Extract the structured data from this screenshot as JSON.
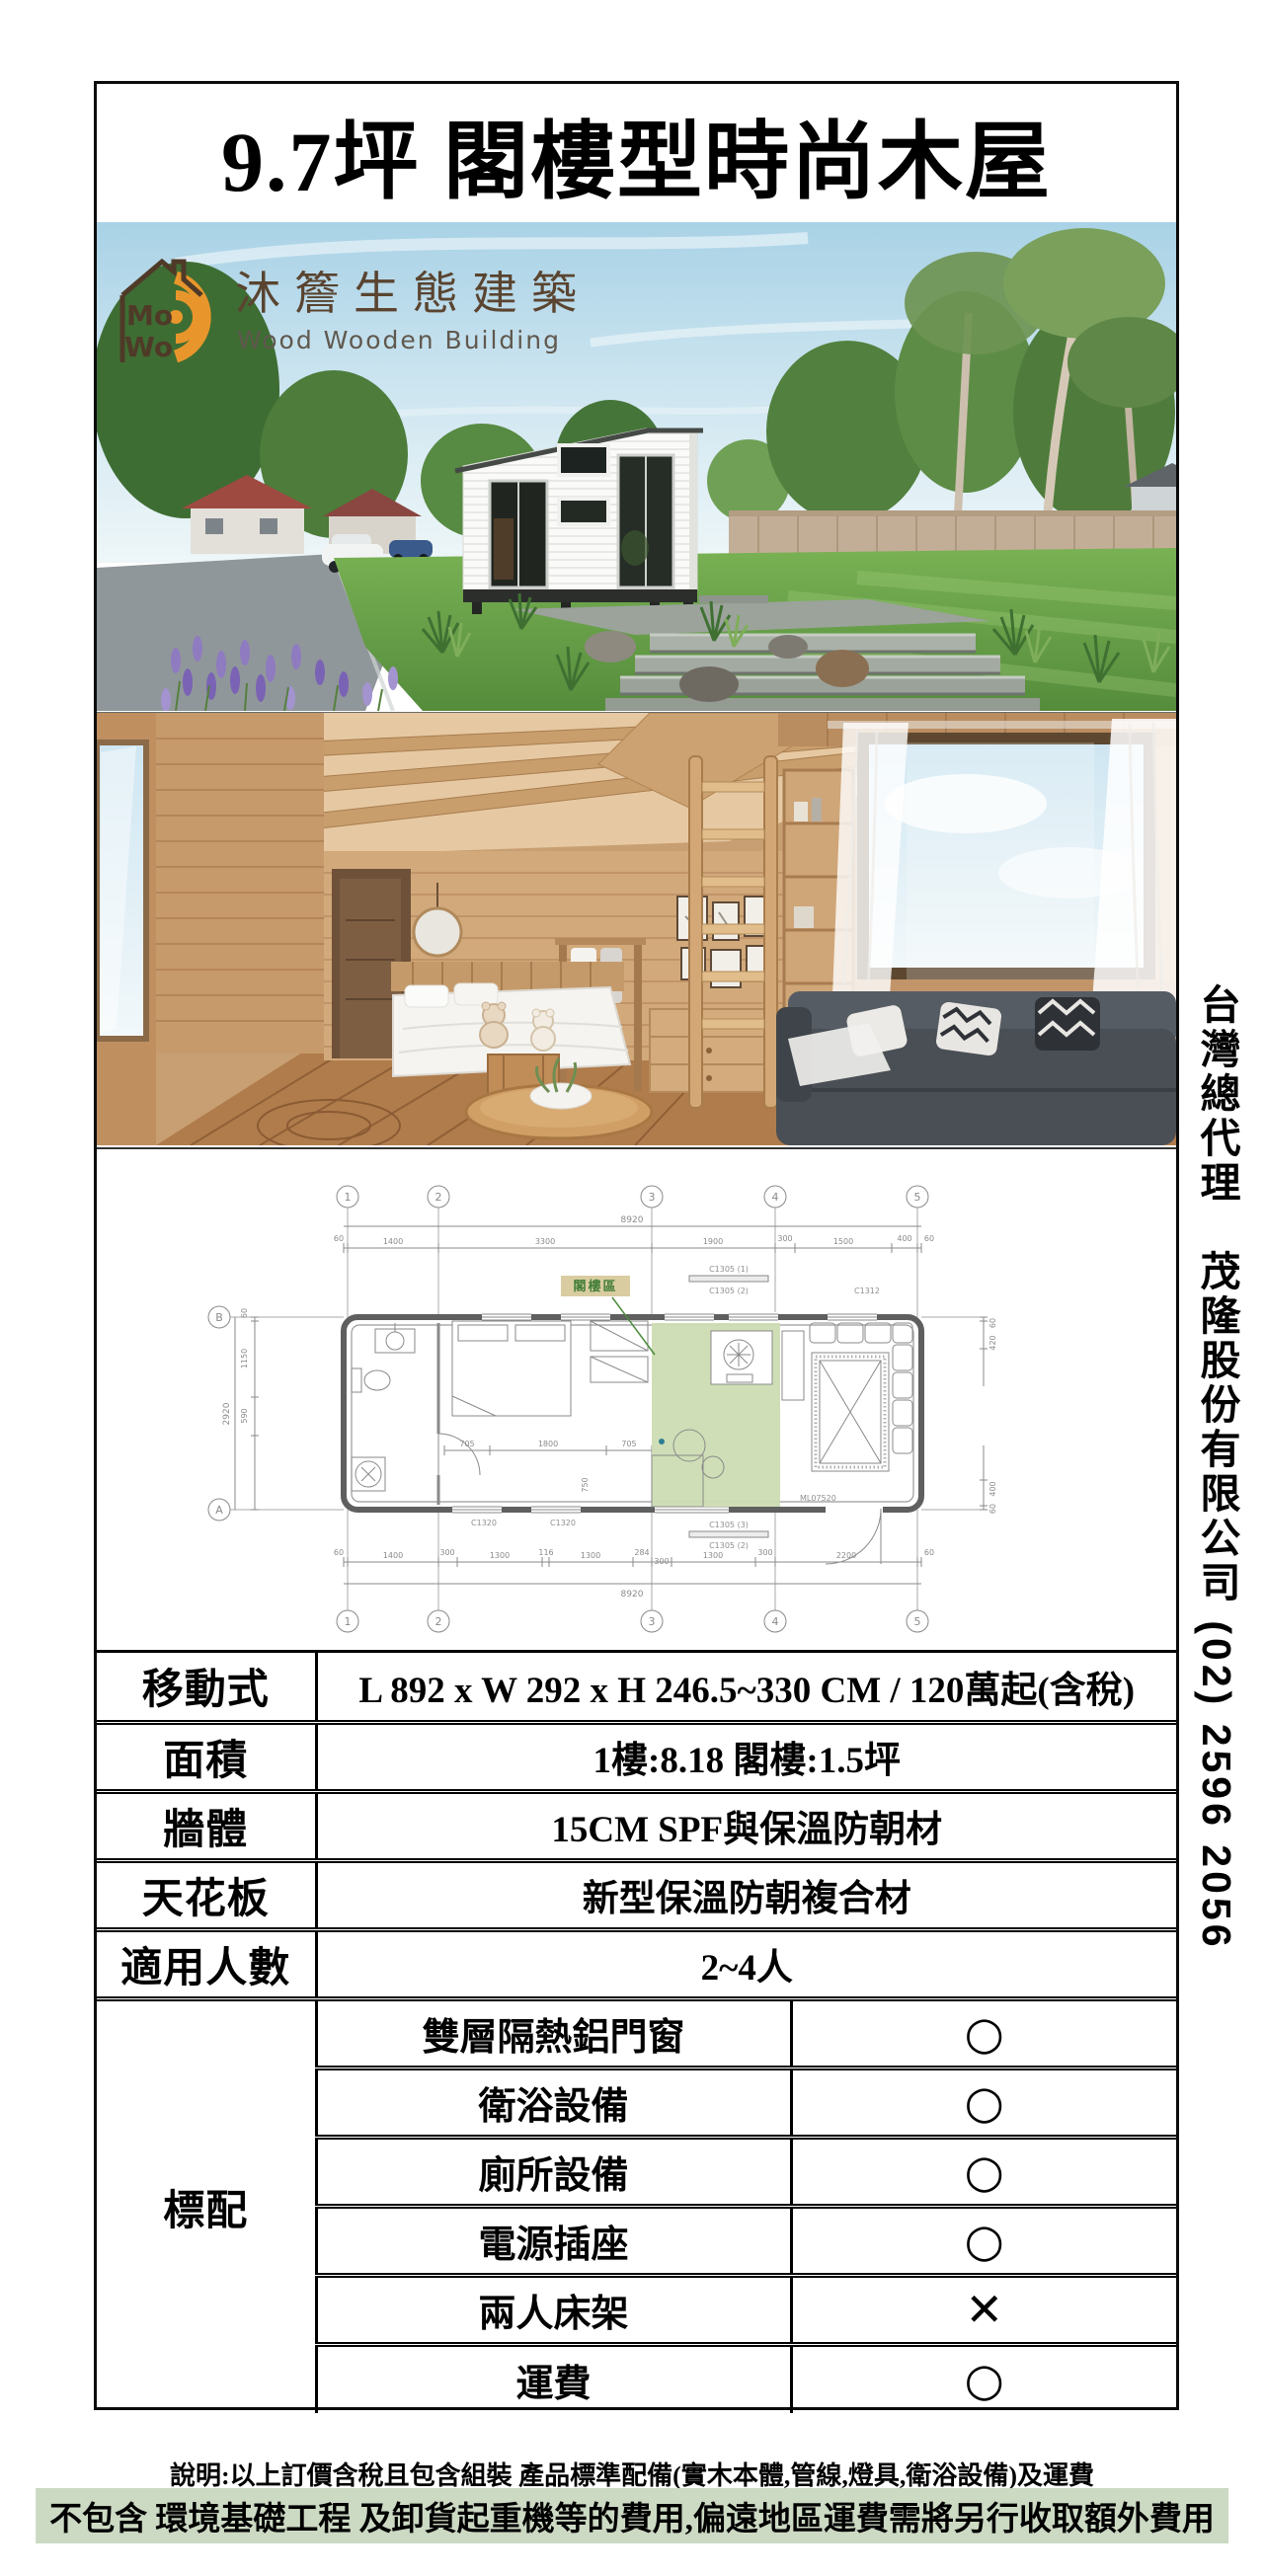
{
  "page": {
    "title": "9.7坪 閣樓型時尚木屋",
    "side_text": "台灣總代理　茂隆股份有限公司 (02) 2596 2056"
  },
  "logo": {
    "name_zh": "沐簷生態建築",
    "name_en": "Wood Wooden Building"
  },
  "floorplan": {
    "grid_cols": [
      "1",
      "2",
      "3",
      "4",
      "5"
    ],
    "grid_rows": [
      "B",
      "A"
    ],
    "total_width": "8920",
    "total_height": "2920",
    "dims_top": [
      "60",
      "1400",
      "3300",
      "1900",
      "300",
      "1500",
      "400",
      "60"
    ],
    "dims_bottom": [
      "60",
      "1400",
      "300",
      "1300",
      "116",
      "1300",
      "284",
      "300",
      "1300",
      "300",
      "2200",
      "60"
    ],
    "dims_left": [
      "60",
      "1150",
      "590"
    ],
    "dims_right": [
      "60",
      "420",
      "400",
      "60"
    ],
    "dims_internal": [
      "705",
      "1800",
      "705",
      "750"
    ],
    "loft_label": "閣樓區",
    "window_labels": [
      "C1305 (1)",
      "C1305 (2)",
      "C1312",
      "C1320",
      "C1320",
      "C1305 (3)",
      "C1305 (2)",
      "ML07520"
    ]
  },
  "spec_table": {
    "rows": [
      {
        "label": "移動式",
        "value": "L 892 x W 292 x H 246.5~330 CM / 120萬起(含稅)"
      },
      {
        "label": "面積",
        "value": "1樓:8.18  閣樓:1.5坪"
      },
      {
        "label": "牆體",
        "value": "15CM  SPF與保溫防朝材"
      },
      {
        "label": "天花板",
        "value": "新型保溫防朝複合材"
      },
      {
        "label": "適用人數",
        "value": "2~4人"
      }
    ],
    "standard_label": "標配",
    "standard_items": [
      {
        "name": "雙層隔熱鋁門窗",
        "mark": "○"
      },
      {
        "name": "衛浴設備",
        "mark": "○"
      },
      {
        "name": "廁所設備",
        "mark": "○"
      },
      {
        "name": "電源插座",
        "mark": "○"
      },
      {
        "name": "兩人床架",
        "mark": "✕"
      },
      {
        "name": "運費",
        "mark": "○"
      }
    ]
  },
  "footer": {
    "line1": "說明:以上訂價含稅且包含組裝 產品標準配備(實木本體,管線,燈具,衛浴設備)及運費",
    "line2": "不包含 環境基礎工程 及卸貨起重機等的費用,偏遠地區運費需將另行收取額外費用"
  },
  "colors": {
    "highlight_green": "#ccd9c3",
    "loft_green": "#ccdcb2",
    "logo_orange": "#e8962c",
    "logo_brown": "#5a4430"
  }
}
